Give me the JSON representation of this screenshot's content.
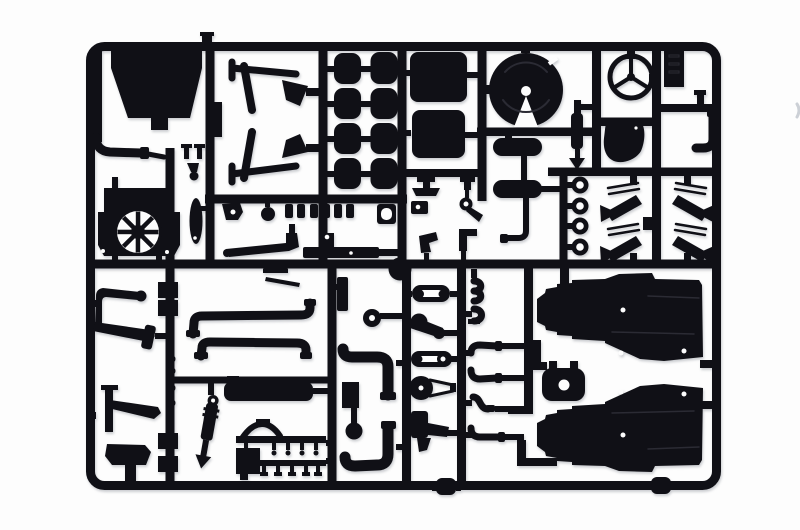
{
  "scene": {
    "description": "Black injection-molded model kit sprue (parts runner) of truck components photographed on a white background: cab panel, chassis rails, eight air tanks, seat cushions, fifth-wheel coupling plate, Mercedes-style steering wheel, mud flap, radiator with fan, leaf springs, exhaust pipes, muffler, engine and gearbox half shells, pulleys, elbow fittings and tow rings.",
    "width_px": 800,
    "height_px": 530
  },
  "colors": {
    "plastic": "#101016",
    "paper": "#fdfdfd",
    "detail": "#2b2b34",
    "artifact": "#ccd0d6"
  },
  "frame": {
    "outer_left": 86,
    "outer_top": 42,
    "outer_right": 721,
    "outer_bottom": 490,
    "bar_thickness": 9,
    "corner_radius": 14
  },
  "parts": [
    {
      "id": "cab-floor-panel"
    },
    {
      "id": "intake-pipe"
    },
    {
      "id": "radiator-fan"
    },
    {
      "id": "mirror-arm"
    },
    {
      "id": "chassis-rails"
    },
    {
      "id": "air-tank-grid"
    },
    {
      "id": "seat-cushions"
    },
    {
      "id": "fifth-wheel-plate"
    },
    {
      "id": "shock-lever"
    },
    {
      "id": "horizontal-air-tanks"
    },
    {
      "id": "tow-rings"
    },
    {
      "id": "mud-flap"
    },
    {
      "id": "steering-wheel"
    },
    {
      "id": "runner-tab"
    },
    {
      "id": "exhaust-stack-elbow"
    },
    {
      "id": "mudflap-brackets"
    },
    {
      "id": "small-fittings-row"
    },
    {
      "id": "junction-ball"
    },
    {
      "id": "leaf-spring-clusters"
    },
    {
      "id": "clip-bobbins"
    },
    {
      "id": "exhaust-pipes"
    },
    {
      "id": "muffler"
    },
    {
      "id": "shock-absorber"
    },
    {
      "id": "air-line-harness"
    },
    {
      "id": "pipe-loops"
    },
    {
      "id": "pulley-belt-set"
    },
    {
      "id": "elbow-fittings"
    },
    {
      "id": "engine-mount"
    },
    {
      "id": "engine-gearbox-halves"
    },
    {
      "id": "bottom-rod-connectors"
    }
  ]
}
